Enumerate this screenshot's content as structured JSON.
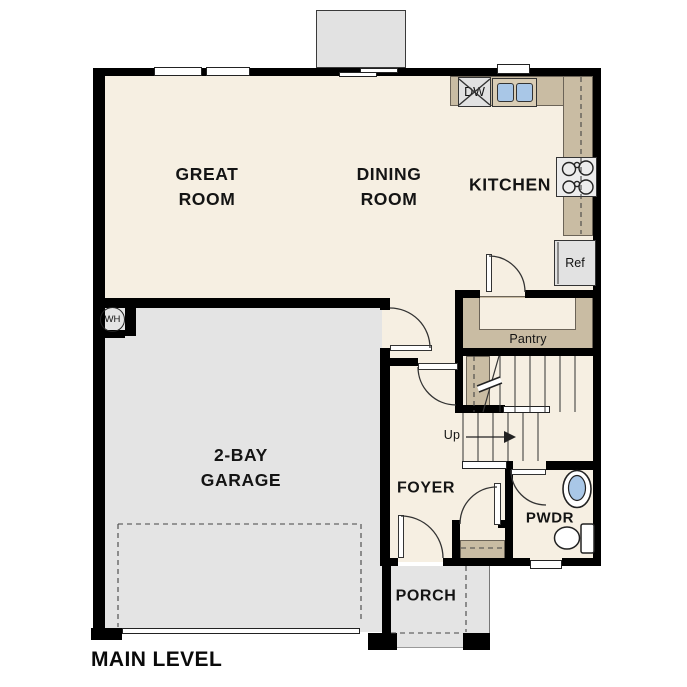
{
  "plan_title": "MAIN LEVEL",
  "rooms": {
    "great_room": "GREAT\nROOM",
    "dining_room": "DINING\nROOM",
    "kitchen": "KITCHEN",
    "garage": "2-BAY\nGARAGE",
    "foyer": "FOYER",
    "powder_room": "PWDR",
    "porch": "PORCH",
    "pantry": "Pantry"
  },
  "labels": {
    "stairs_direction": "Up",
    "dishwasher": "DW",
    "refrigerator": "Ref",
    "water_heater": "WH"
  },
  "colors": {
    "floor-cream": "#F6EFE2",
    "floor-gray": "#E4E4E4",
    "cabinet-tan": "#C9BCA3",
    "fixture-blue": "#A9C7E7",
    "appliance-gray": "#E2E2E2",
    "wall-black": "#000000",
    "line": "#333333"
  }
}
